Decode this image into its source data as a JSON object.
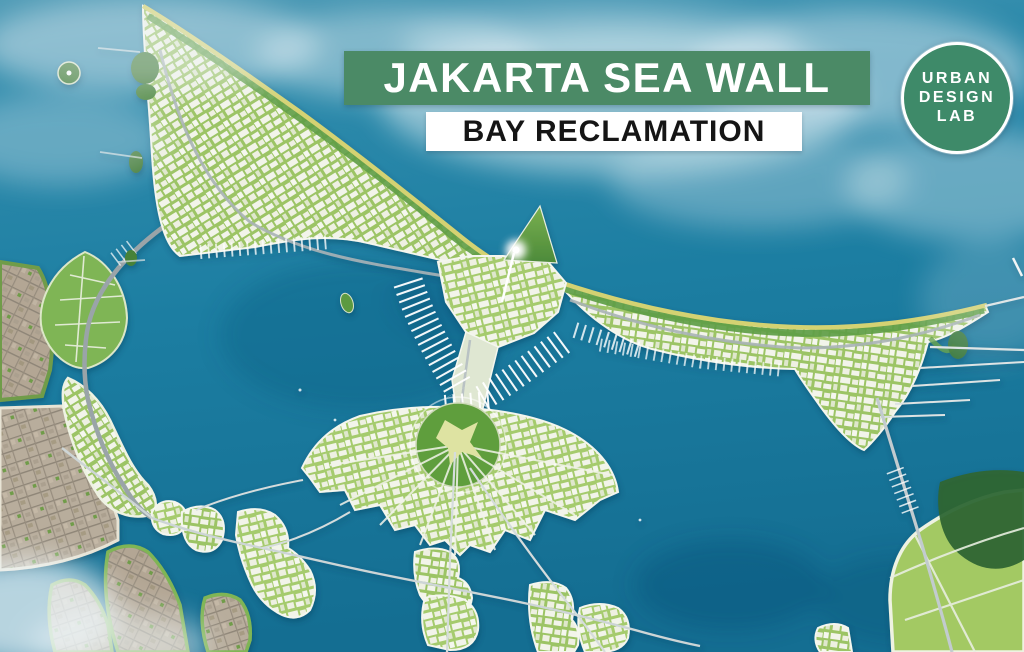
{
  "header": {
    "title": "JAKARTA SEA WALL",
    "subtitle": "BAY RECLAMATION"
  },
  "logo": {
    "lines": [
      "URBAN",
      "DESIGN",
      "LAB"
    ]
  },
  "colors": {
    "banner_green": "#4b8a66",
    "banner_text": "#ffffff",
    "subtitle_bg": "#ffffff",
    "subtitle_text": "#151515",
    "logo_green": "#3e8a69",
    "logo_text": "#ffffff",
    "sea_light": "#4e9ab5",
    "sea_mid": "#1c7ea2",
    "sea_deep": "#146e92",
    "beach_sand": "#d4d272",
    "greenery": "#8cbc5a",
    "tree_green": "#5f9d45",
    "forest_dark": "#2e6633",
    "urban_block": "#f2f4ea",
    "existing_city": "#b3a694",
    "road_grey": "#a8b2b6",
    "bridge_light": "#d5dcdc",
    "cloud_white": "#eef5f8"
  }
}
